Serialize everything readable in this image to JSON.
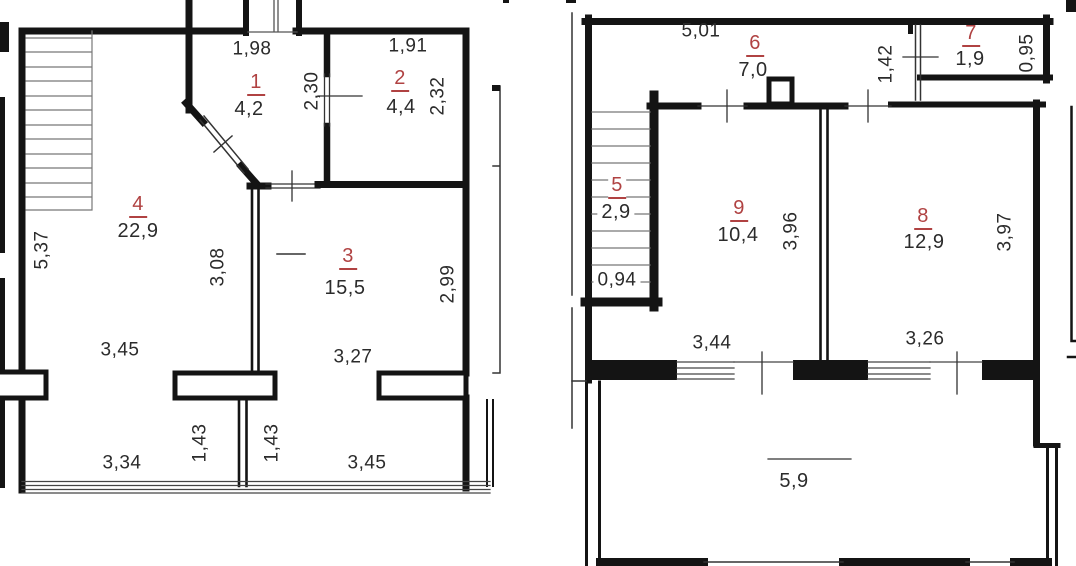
{
  "colors": {
    "room_number": "#b04242",
    "wall": "#141414",
    "dim_text": "#2b2b2b"
  },
  "floor1": {
    "rooms": [
      {
        "number": "1",
        "area": "4,2"
      },
      {
        "number": "2",
        "area": "4,4"
      },
      {
        "number": "3",
        "area": "15,5"
      },
      {
        "number": "4",
        "area": "22,9"
      }
    ],
    "dims": {
      "room1_width": "1,98",
      "room2_width": "1,91",
      "door12_height": "2,30",
      "room2_height": "2,32",
      "stair_height": "5,37",
      "room3_left_wall": "3,08",
      "room3_height": "2,99",
      "room4_width": "3,45",
      "room3_width": "3,27",
      "balcony_width_left": "3,34",
      "balcony_depth_left": "1,43",
      "balcony_depth_right": "1,43",
      "balcony_width_right": "3,45"
    }
  },
  "floor2": {
    "rooms": [
      {
        "number": "5",
        "area": "2,9"
      },
      {
        "number": "6",
        "area": "7,0"
      },
      {
        "number": "7",
        "area": "1,9"
      },
      {
        "number": "8",
        "area": "12,9"
      },
      {
        "number": "9",
        "area": "10,4"
      }
    ],
    "terrace_area": "5,9",
    "dims": {
      "hall_width": "5,01",
      "hall_door": "1,42",
      "room7_depth": "0,95",
      "stair_width": "0,94",
      "room9_height": "3,96",
      "room8_height": "3,97",
      "room9_window": "3,44",
      "room8_window": "3,26"
    }
  }
}
